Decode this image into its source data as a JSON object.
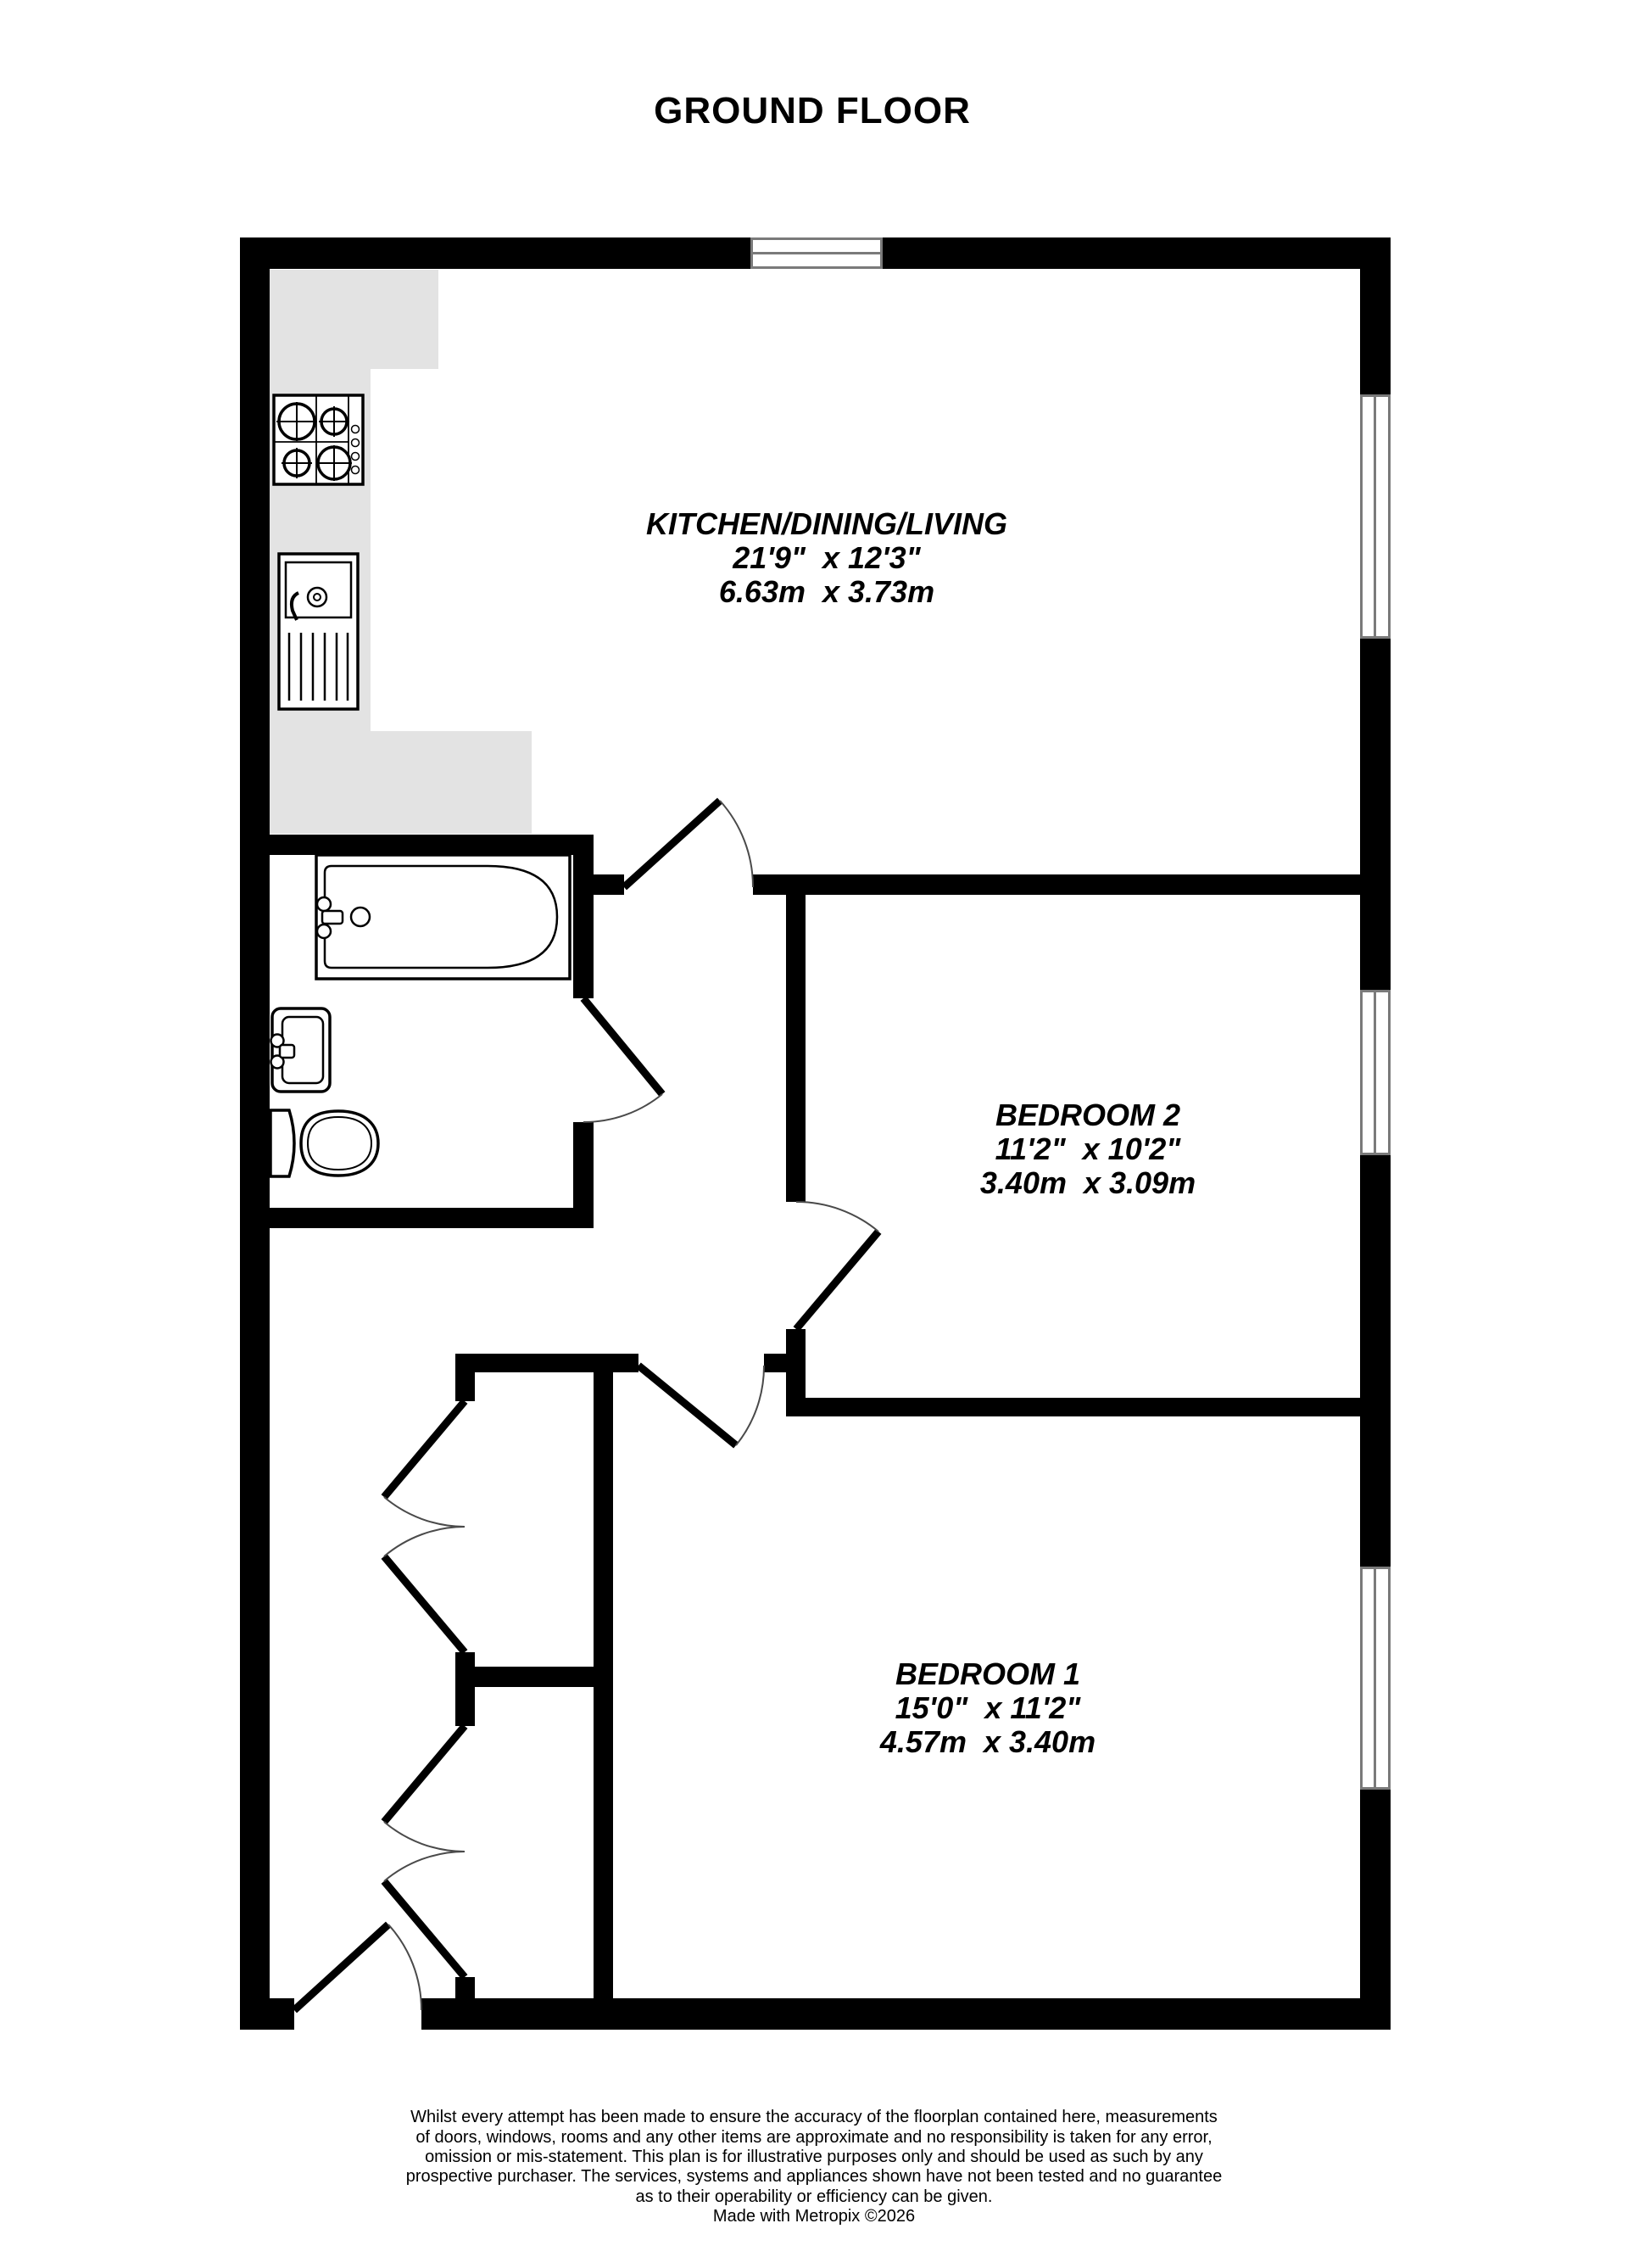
{
  "title": "GROUND FLOOR",
  "rooms": {
    "kitchen": {
      "name": "KITCHEN/DINING/LIVING",
      "imperial": "21'9\"  x 12'3\"",
      "metric": "6.63m  x 3.73m"
    },
    "bedroom2": {
      "name": "BEDROOM 2",
      "imperial": "11'2\"  x 10'2\"",
      "metric": "3.40m  x 3.09m"
    },
    "bedroom1": {
      "name": "BEDROOM 1",
      "imperial": "15'0\"  x 11'2\"",
      "metric": "4.57m  x 3.40m"
    }
  },
  "fixtures": [
    "hob",
    "kitchen-sink",
    "bathtub",
    "basin",
    "toilet"
  ],
  "doors": [
    "entrance-door",
    "kitchen-door",
    "bathroom-door",
    "bedroom-2-door",
    "bedroom-1-door",
    "hall-cupboard-doors-1",
    "hall-cupboard-doors-2"
  ],
  "windows": [
    "top-window",
    "kitchen-window",
    "bedroom-2-window",
    "bedroom-1-window"
  ],
  "colors": {
    "wall": "#000000",
    "counter": "#e3e3e3",
    "window_frame": "#7a7a7a",
    "door_arc": "#4a4a4a",
    "text": "#000000",
    "background": "#ffffff"
  },
  "footer": {
    "lines": [
      "Whilst every attempt has been made to ensure the accuracy of the floorplan contained here, measurements",
      "of doors, windows, rooms and any other items are approximate and no responsibility is taken for any error,",
      "omission or mis-statement. This plan is for illustrative purposes only and should be used as such by any",
      "prospective purchaser. The services, systems and appliances shown have not been tested and no guarantee",
      "as to their operability or efficiency can be given.",
      "Made with Metropix ©2026"
    ]
  }
}
